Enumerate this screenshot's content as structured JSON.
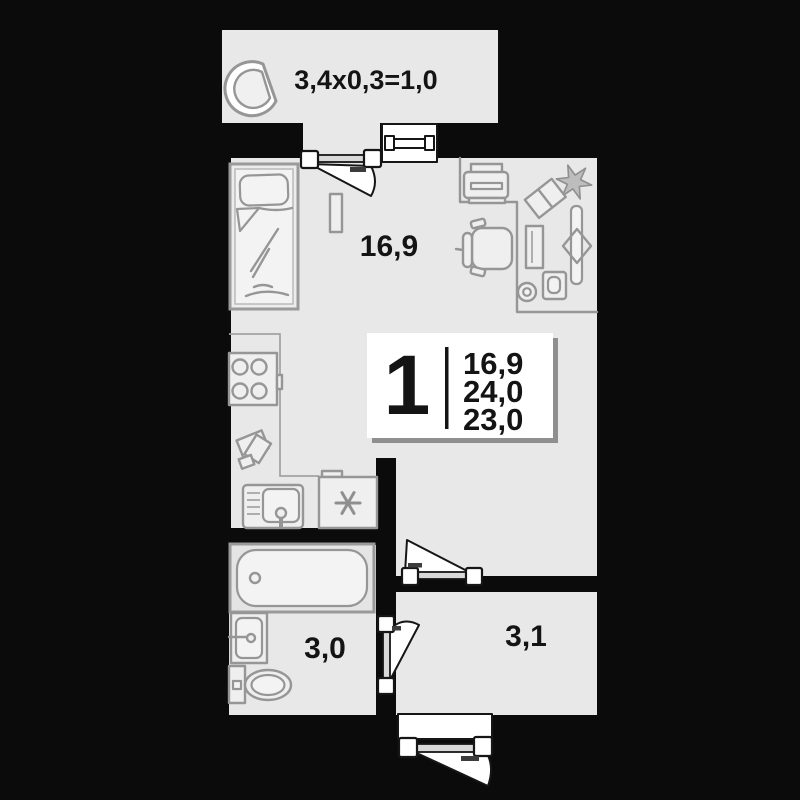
{
  "floor_plan": {
    "type": "apartment-floor-plan",
    "balcony": {
      "dimension_label": "3,4x0,3=1,0"
    },
    "living_room": {
      "area_label": "16,9"
    },
    "bathroom": {
      "area_label": "3,0"
    },
    "hallway": {
      "area_label": "3,1"
    },
    "info_plate": {
      "room_count": "1",
      "living_area": "16,9",
      "total_area": "24,0",
      "area_reduced": "23,0"
    },
    "colors": {
      "background": "#0b0b0b",
      "floor": "#e8e8e8",
      "furniture_stroke": "#969696",
      "label_text": "#141414",
      "plate_background": "#ffffff",
      "plate_shadow": "#8f8f8f"
    }
  }
}
